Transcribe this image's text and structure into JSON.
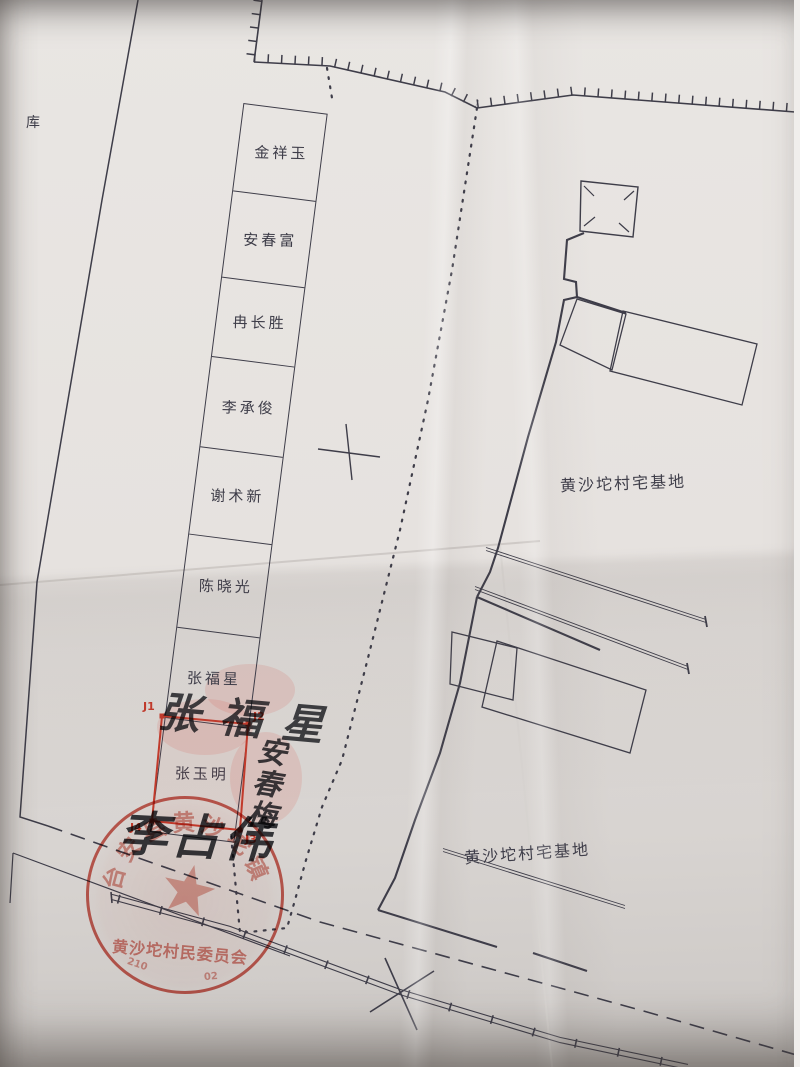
{
  "labels": {
    "warehouse": "库",
    "area_label_north": "黄沙坨村宅基地",
    "area_label_south": "黄沙坨村宅基地"
  },
  "plots": [
    "金祥玉",
    "安春富",
    "冉长胜",
    "李承俊",
    "谢术新",
    "陈晓光",
    "张福星",
    "张玉明"
  ],
  "markers": {
    "j1": "J1",
    "j2": "J2",
    "j3": "J3",
    "j4": "J4"
  },
  "handwriting": {
    "name_top": "张福星",
    "name_side": "安春梅",
    "signature": "李占伟"
  },
  "seal": {
    "arc_text_chars": [
      "台",
      "安",
      "县",
      "黄",
      "沙",
      "坨",
      "镇"
    ],
    "line_text": "黄沙坨村民委员会",
    "serial_left": "210",
    "serial_right": "02"
  },
  "colors": {
    "ink": "#3e3d49",
    "red": "#c23a2b",
    "seal_red": "#c43f30",
    "paper": "#e4e0dd",
    "handwriting_ink": "#2b2d33"
  }
}
